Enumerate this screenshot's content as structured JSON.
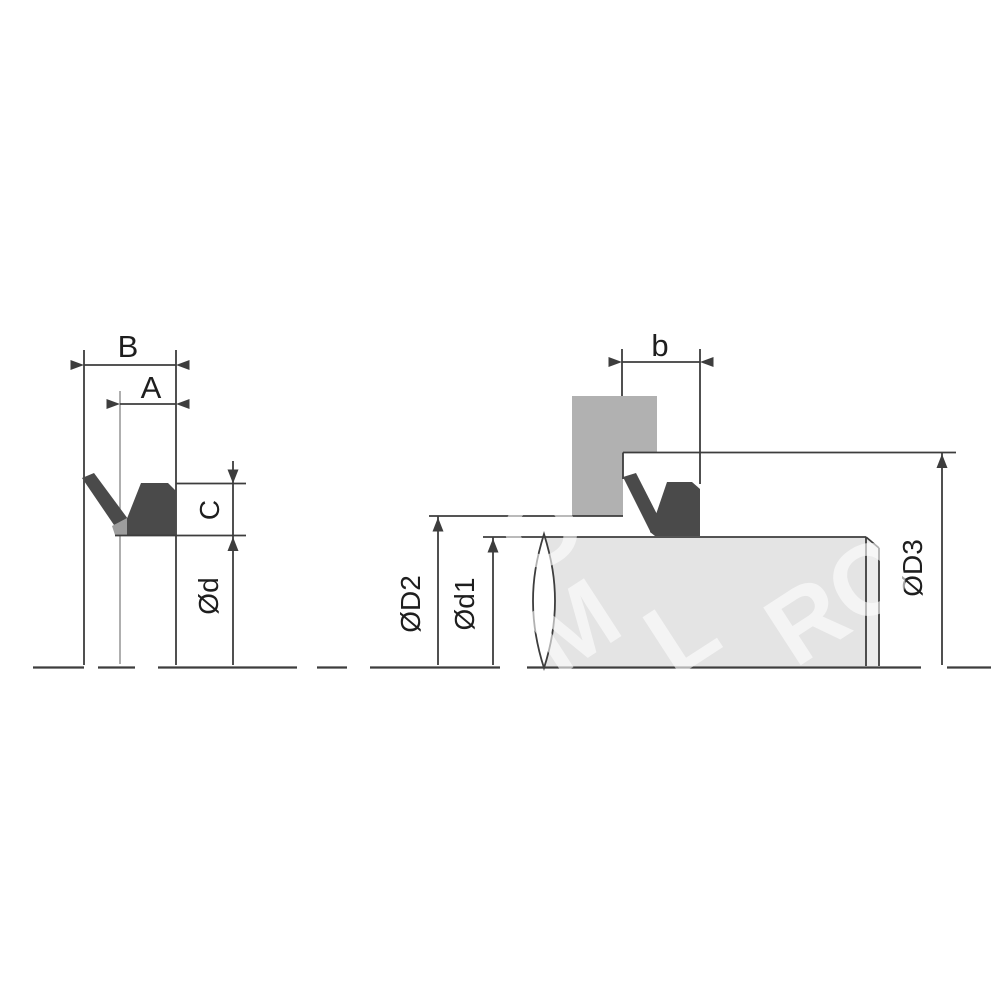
{
  "drawing": {
    "type": "technical-drawing",
    "left_view": {
      "horizontal_dimensions": [
        "B",
        "A"
      ],
      "vertical_dimensions": [
        "C",
        "Ød"
      ]
    },
    "right_view": {
      "horizontal_dimensions": [
        "b"
      ],
      "vertical_dimensions": [
        "ØD2",
        "Ød1",
        "ØD3"
      ]
    }
  },
  "labels": {
    "B": "B",
    "A": "A",
    "C": "C",
    "d": "Ød",
    "b": "b",
    "D2": "ØD2",
    "d1": "Ød1",
    "D3": "ØD3"
  },
  "watermark": {
    "fragments": [
      "O",
      "M",
      "L",
      "RO"
    ]
  },
  "colors": {
    "bg": "#ffffff",
    "line": "#3d3d3d",
    "faintline": "#8d8d8d",
    "text": "#1e1e1e",
    "seal": "#4a4a4a",
    "housing": "#b1b1b1",
    "shaft": "#e4e4e4",
    "chamfer": "#ececec",
    "wedge": "#9d9d9d",
    "lensfill": "#ffffff",
    "watermark": "rgba(255,255,255,0.6)"
  }
}
